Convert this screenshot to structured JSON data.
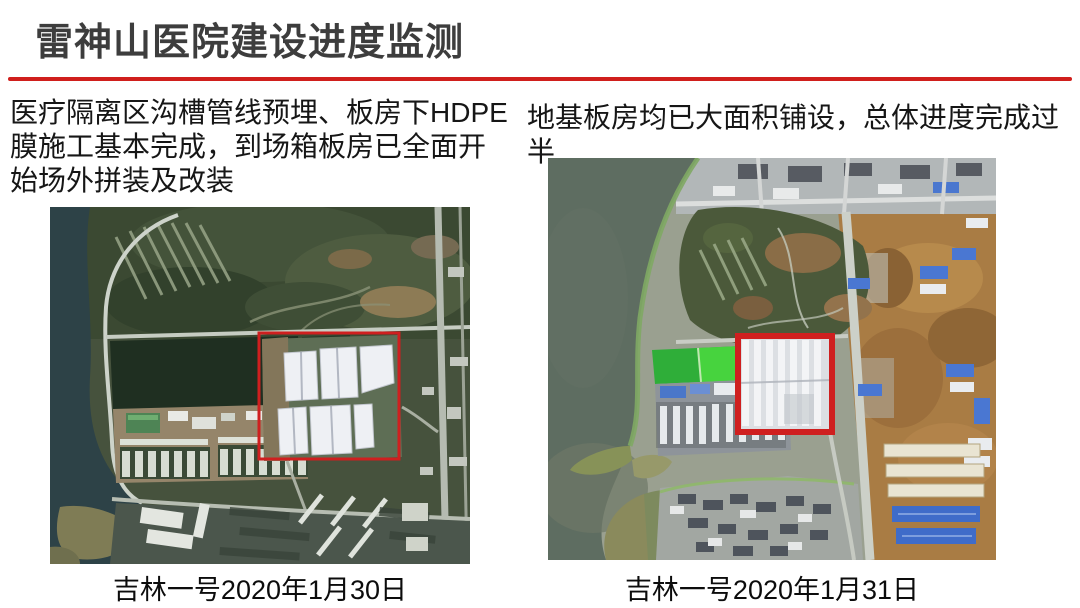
{
  "title": "雷神山医院建设进度监测",
  "divider_color": "#d01f1c",
  "highlight_box_color": "#cf1f1f",
  "left_panel": {
    "description_lines": [
      "医疗隔离区沟槽管线预埋、板房下HDPE",
      "膜施工基本完成，到场箱板房已全面开",
      "始场外拼装及改装"
    ],
    "caption": "吉林一号2020年1月30日"
  },
  "right_panel": {
    "description": "地基板房均已大面积铺设，总体进度完成过半",
    "caption": "吉林一号2020年1月31日"
  }
}
